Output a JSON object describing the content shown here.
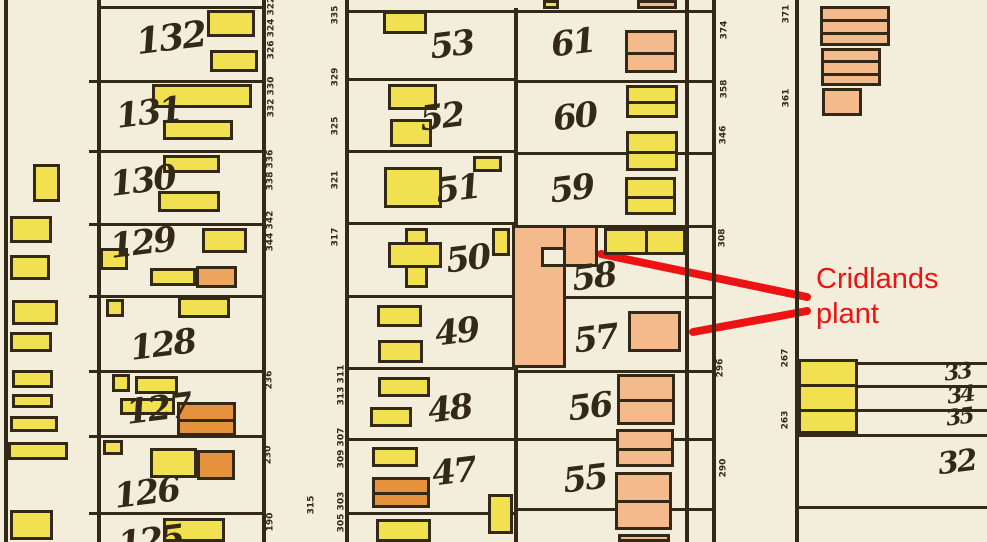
{
  "map": {
    "paper": "#f3eedb",
    "ink": "#342817",
    "colors": {
      "y": "#f1e04f",
      "s": "#f5ba8c",
      "o": "#e6923c",
      "tan": "#eda55f"
    },
    "v_lines": [
      {
        "x": 4,
        "y1": 0,
        "y2": 542
      },
      {
        "x": 97,
        "y1": 0,
        "y2": 542
      },
      {
        "x": 262,
        "y1": 0,
        "y2": 542
      },
      {
        "x": 345,
        "y1": 0,
        "y2": 542
      },
      {
        "x": 514,
        "y1": 8,
        "y2": 542
      },
      {
        "x": 685,
        "y1": 0,
        "y2": 542
      },
      {
        "x": 712,
        "y1": 0,
        "y2": 542
      },
      {
        "x": 795,
        "y1": 0,
        "y2": 542
      }
    ],
    "h_lines": [
      {
        "x1": 100,
        "x2": 262,
        "y": 6
      },
      {
        "x1": 100,
        "x2": 262,
        "y": 80
      },
      {
        "x1": 100,
        "x2": 262,
        "y": 150
      },
      {
        "x1": 100,
        "x2": 262,
        "y": 223
      },
      {
        "x1": 100,
        "x2": 262,
        "y": 295
      },
      {
        "x1": 100,
        "x2": 262,
        "y": 370
      },
      {
        "x1": 100,
        "x2": 262,
        "y": 435
      },
      {
        "x1": 100,
        "x2": 262,
        "y": 512
      },
      {
        "x1": 345,
        "x2": 514,
        "y": 10
      },
      {
        "x1": 345,
        "x2": 514,
        "y": 78
      },
      {
        "x1": 345,
        "x2": 514,
        "y": 150
      },
      {
        "x1": 345,
        "x2": 514,
        "y": 222
      },
      {
        "x1": 345,
        "x2": 514,
        "y": 295
      },
      {
        "x1": 345,
        "x2": 514,
        "y": 367
      },
      {
        "x1": 345,
        "x2": 514,
        "y": 438
      },
      {
        "x1": 345,
        "x2": 514,
        "y": 512
      },
      {
        "x1": 514,
        "x2": 712,
        "y": 10
      },
      {
        "x1": 514,
        "x2": 712,
        "y": 80
      },
      {
        "x1": 514,
        "x2": 712,
        "y": 152
      },
      {
        "x1": 514,
        "x2": 712,
        "y": 225
      },
      {
        "x1": 557,
        "x2": 712,
        "y": 296
      },
      {
        "x1": 514,
        "x2": 712,
        "y": 370
      },
      {
        "x1": 514,
        "x2": 712,
        "y": 438
      },
      {
        "x1": 514,
        "x2": 712,
        "y": 508
      },
      {
        "x1": 856,
        "x2": 987,
        "y": 362
      },
      {
        "x1": 856,
        "x2": 987,
        "y": 385
      },
      {
        "x1": 856,
        "x2": 987,
        "y": 409
      },
      {
        "x1": 795,
        "x2": 987,
        "y": 434
      },
      {
        "x1": 795,
        "x2": 987,
        "y": 506
      }
    ],
    "ticks": [
      {
        "x": 89,
        "y": 80,
        "w": 9
      },
      {
        "x": 89,
        "y": 150,
        "w": 9
      },
      {
        "x": 89,
        "y": 223,
        "w": 9
      },
      {
        "x": 89,
        "y": 295,
        "w": 9
      },
      {
        "x": 89,
        "y": 370,
        "w": 9
      },
      {
        "x": 89,
        "y": 435,
        "w": 9
      },
      {
        "x": 89,
        "y": 512,
        "w": 9
      }
    ],
    "buildings": [
      {
        "x": 33,
        "y": 164,
        "w": 27,
        "h": 38,
        "c": "y"
      },
      {
        "x": 10,
        "y": 216,
        "w": 42,
        "h": 27,
        "c": "y"
      },
      {
        "x": 10,
        "y": 255,
        "w": 40,
        "h": 25,
        "c": "y"
      },
      {
        "x": 12,
        "y": 300,
        "w": 46,
        "h": 25,
        "c": "y"
      },
      {
        "x": 10,
        "y": 332,
        "w": 42,
        "h": 20,
        "c": "y"
      },
      {
        "x": 12,
        "y": 370,
        "w": 41,
        "h": 18,
        "c": "y"
      },
      {
        "x": 12,
        "y": 394,
        "w": 41,
        "h": 14,
        "c": "y"
      },
      {
        "x": 10,
        "y": 416,
        "w": 48,
        "h": 16,
        "c": "y"
      },
      {
        "x": 8,
        "y": 442,
        "w": 60,
        "h": 18,
        "c": "y"
      },
      {
        "x": 10,
        "y": 510,
        "w": 43,
        "h": 30,
        "c": "y"
      },
      {
        "x": 207,
        "y": 10,
        "w": 48,
        "h": 27,
        "c": "y"
      },
      {
        "x": 210,
        "y": 50,
        "w": 48,
        "h": 22,
        "c": "y"
      },
      {
        "x": 152,
        "y": 84,
        "w": 100,
        "h": 24,
        "c": "y"
      },
      {
        "x": 163,
        "y": 120,
        "w": 70,
        "h": 20,
        "c": "y"
      },
      {
        "x": 163,
        "y": 155,
        "w": 57,
        "h": 18,
        "c": "y"
      },
      {
        "x": 158,
        "y": 191,
        "w": 62,
        "h": 21,
        "c": "y"
      },
      {
        "x": 202,
        "y": 228,
        "w": 45,
        "h": 25,
        "c": "y"
      },
      {
        "x": 100,
        "y": 248,
        "w": 28,
        "h": 22,
        "c": "y"
      },
      {
        "x": 150,
        "y": 268,
        "w": 46,
        "h": 18,
        "c": "y"
      },
      {
        "x": 196,
        "y": 266,
        "w": 41,
        "h": 22,
        "c": "tan"
      },
      {
        "x": 178,
        "y": 297,
        "w": 52,
        "h": 21,
        "c": "y"
      },
      {
        "x": 106,
        "y": 299,
        "w": 18,
        "h": 18,
        "c": "y"
      },
      {
        "x": 112,
        "y": 374,
        "w": 18,
        "h": 18,
        "c": "y"
      },
      {
        "x": 135,
        "y": 376,
        "w": 43,
        "h": 18,
        "c": "y"
      },
      {
        "x": 120,
        "y": 398,
        "w": 55,
        "h": 17,
        "c": "y"
      },
      {
        "x": 177,
        "y": 402,
        "w": 59,
        "h": 34,
        "c": "o",
        "dy": [
          419
        ]
      },
      {
        "x": 103,
        "y": 440,
        "w": 20,
        "h": 15,
        "c": "y"
      },
      {
        "x": 150,
        "y": 448,
        "w": 47,
        "h": 30,
        "c": "y"
      },
      {
        "x": 197,
        "y": 450,
        "w": 38,
        "h": 30,
        "c": "o"
      },
      {
        "x": 163,
        "y": 518,
        "w": 62,
        "h": 24,
        "c": "y"
      },
      {
        "x": 383,
        "y": 11,
        "w": 44,
        "h": 23,
        "c": "y"
      },
      {
        "x": 388,
        "y": 84,
        "w": 49,
        "h": 26,
        "c": "y"
      },
      {
        "x": 390,
        "y": 119,
        "w": 42,
        "h": 28,
        "c": "y"
      },
      {
        "x": 384,
        "y": 167,
        "w": 58,
        "h": 41,
        "c": "y"
      },
      {
        "x": 473,
        "y": 156,
        "w": 29,
        "h": 16,
        "c": "y"
      },
      {
        "x": 405,
        "y": 228,
        "w": 23,
        "h": 60,
        "c": "y"
      },
      {
        "x": 388,
        "y": 242,
        "w": 54,
        "h": 26,
        "c": "y"
      },
      {
        "x": 492,
        "y": 228,
        "w": 18,
        "h": 28,
        "c": "y"
      },
      {
        "x": 377,
        "y": 305,
        "w": 45,
        "h": 22,
        "c": "y"
      },
      {
        "x": 378,
        "y": 340,
        "w": 45,
        "h": 23,
        "c": "y"
      },
      {
        "x": 378,
        "y": 377,
        "w": 52,
        "h": 20,
        "c": "y"
      },
      {
        "x": 370,
        "y": 407,
        "w": 42,
        "h": 20,
        "c": "y"
      },
      {
        "x": 372,
        "y": 447,
        "w": 46,
        "h": 20,
        "c": "y"
      },
      {
        "x": 372,
        "y": 477,
        "w": 58,
        "h": 31,
        "c": "o",
        "dy": [
          492
        ]
      },
      {
        "x": 488,
        "y": 494,
        "w": 25,
        "h": 40,
        "c": "y"
      },
      {
        "x": 376,
        "y": 519,
        "w": 55,
        "h": 23,
        "c": "y"
      },
      {
        "x": 512,
        "y": 225,
        "w": 54,
        "h": 143,
        "c": "s"
      },
      {
        "x": 563,
        "y": 225,
        "w": 35,
        "h": 42,
        "c": "s"
      },
      {
        "x": 543,
        "y": 0,
        "w": 16,
        "h": 9,
        "c": "y"
      },
      {
        "x": 637,
        "y": 0,
        "w": 40,
        "h": 9,
        "c": "s"
      },
      {
        "x": 625,
        "y": 30,
        "w": 52,
        "h": 43,
        "c": "s",
        "dy": [
          52
        ]
      },
      {
        "x": 626,
        "y": 85,
        "w": 52,
        "h": 33,
        "c": "y",
        "dy": [
          101
        ]
      },
      {
        "x": 626,
        "y": 131,
        "w": 52,
        "h": 40,
        "c": "y",
        "dy": [
          151
        ]
      },
      {
        "x": 625,
        "y": 177,
        "w": 51,
        "h": 38,
        "c": "y",
        "dy": [
          196
        ]
      },
      {
        "x": 604,
        "y": 228,
        "w": 82,
        "h": 27,
        "c": "y",
        "dx": [
          645
        ]
      },
      {
        "x": 628,
        "y": 311,
        "w": 53,
        "h": 41,
        "c": "s"
      },
      {
        "x": 617,
        "y": 374,
        "w": 58,
        "h": 51,
        "c": "s",
        "dy": [
          399
        ]
      },
      {
        "x": 616,
        "y": 429,
        "w": 58,
        "h": 38,
        "c": "s",
        "dy": [
          448
        ]
      },
      {
        "x": 615,
        "y": 472,
        "w": 57,
        "h": 58,
        "c": "s",
        "dy": [
          500
        ]
      },
      {
        "x": 618,
        "y": 534,
        "w": 52,
        "h": 8,
        "c": "s"
      },
      {
        "x": 820,
        "y": 6,
        "w": 70,
        "h": 40,
        "c": "s",
        "dy": [
          19,
          32
        ]
      },
      {
        "x": 821,
        "y": 48,
        "w": 60,
        "h": 38,
        "c": "s",
        "dy": [
          60,
          73
        ]
      },
      {
        "x": 822,
        "y": 88,
        "w": 40,
        "h": 28,
        "c": "s"
      },
      {
        "x": 798,
        "y": 359,
        "w": 60,
        "h": 75,
        "c": "y",
        "dy": [
          384,
          409
        ]
      }
    ],
    "plant_notch": {
      "x": 541,
      "y": 247,
      "w": 25,
      "h": 20
    },
    "lot_labels": [
      {
        "t": "132",
        "x": 136,
        "y": 20,
        "s": 36
      },
      {
        "t": "131",
        "x": 116,
        "y": 96,
        "s": 34
      },
      {
        "t": "130",
        "x": 110,
        "y": 164,
        "s": 34
      },
      {
        "t": "129",
        "x": 110,
        "y": 226,
        "s": 34
      },
      {
        "t": "128",
        "x": 130,
        "y": 328,
        "s": 34
      },
      {
        "t": "127",
        "x": 126,
        "y": 392,
        "s": 34
      },
      {
        "t": "126",
        "x": 114,
        "y": 476,
        "s": 34
      },
      {
        "t": "125",
        "x": 118,
        "y": 524,
        "s": 34
      },
      {
        "t": "53",
        "x": 430,
        "y": 28,
        "s": 34
      },
      {
        "t": "52",
        "x": 420,
        "y": 100,
        "s": 34
      },
      {
        "t": "51",
        "x": 436,
        "y": 172,
        "s": 34
      },
      {
        "t": "50",
        "x": 446,
        "y": 242,
        "s": 34
      },
      {
        "t": "49",
        "x": 435,
        "y": 315,
        "s": 34
      },
      {
        "t": "48",
        "x": 428,
        "y": 392,
        "s": 34
      },
      {
        "t": "47",
        "x": 432,
        "y": 455,
        "s": 34
      },
      {
        "t": "61",
        "x": 551,
        "y": 26,
        "s": 34
      },
      {
        "t": "60",
        "x": 553,
        "y": 100,
        "s": 34
      },
      {
        "t": "59",
        "x": 550,
        "y": 172,
        "s": 34
      },
      {
        "t": "58",
        "x": 572,
        "y": 260,
        "s": 34
      },
      {
        "t": "57",
        "x": 574,
        "y": 322,
        "s": 34
      },
      {
        "t": "56",
        "x": 568,
        "y": 390,
        "s": 34
      },
      {
        "t": "55",
        "x": 563,
        "y": 462,
        "s": 34
      },
      {
        "t": "33",
        "x": 944,
        "y": 361,
        "s": 22
      },
      {
        "t": "34",
        "x": 947,
        "y": 384,
        "s": 22
      },
      {
        "t": "35",
        "x": 946,
        "y": 406,
        "s": 22
      },
      {
        "t": "32",
        "x": 938,
        "y": 448,
        "s": 30
      }
    ],
    "street_numbers": [
      {
        "t": "326 324 322",
        "x": 272,
        "y": 28
      },
      {
        "t": "332 330",
        "x": 272,
        "y": 97
      },
      {
        "t": "338 336",
        "x": 271,
        "y": 170
      },
      {
        "t": "344 342",
        "x": 271,
        "y": 231
      },
      {
        "t": "236",
        "x": 270,
        "y": 380
      },
      {
        "t": "230",
        "x": 269,
        "y": 455
      },
      {
        "t": "190",
        "x": 271,
        "y": 522
      },
      {
        "t": "335",
        "x": 336,
        "y": 15
      },
      {
        "t": "329",
        "x": 336,
        "y": 77
      },
      {
        "t": "325",
        "x": 336,
        "y": 126
      },
      {
        "t": "321",
        "x": 336,
        "y": 180
      },
      {
        "t": "317",
        "x": 336,
        "y": 237
      },
      {
        "t": "315",
        "x": 312,
        "y": 505
      },
      {
        "t": "313 311",
        "x": 342,
        "y": 385
      },
      {
        "t": "309 307",
        "x": 342,
        "y": 448
      },
      {
        "t": "305 303",
        "x": 342,
        "y": 512
      },
      {
        "t": "374",
        "x": 725,
        "y": 30
      },
      {
        "t": "358",
        "x": 725,
        "y": 89
      },
      {
        "t": "346",
        "x": 724,
        "y": 135
      },
      {
        "t": "308",
        "x": 723,
        "y": 238
      },
      {
        "t": "296",
        "x": 721,
        "y": 368
      },
      {
        "t": "290",
        "x": 724,
        "y": 468
      },
      {
        "t": "371",
        "x": 787,
        "y": 14
      },
      {
        "t": "361",
        "x": 787,
        "y": 98
      },
      {
        "t": "267",
        "x": 786,
        "y": 358
      },
      {
        "t": "263",
        "x": 786,
        "y": 420
      }
    ]
  },
  "annotation": {
    "color": "#ee1313",
    "text_line1": "Cridlands",
    "text_line2": "plant",
    "text_x": 816,
    "text_y": 262,
    "lines": [
      {
        "x1": 601,
        "y1": 254,
        "x2": 807,
        "y2": 297
      },
      {
        "x1": 693,
        "y1": 332,
        "x2": 807,
        "y2": 311
      }
    ]
  }
}
